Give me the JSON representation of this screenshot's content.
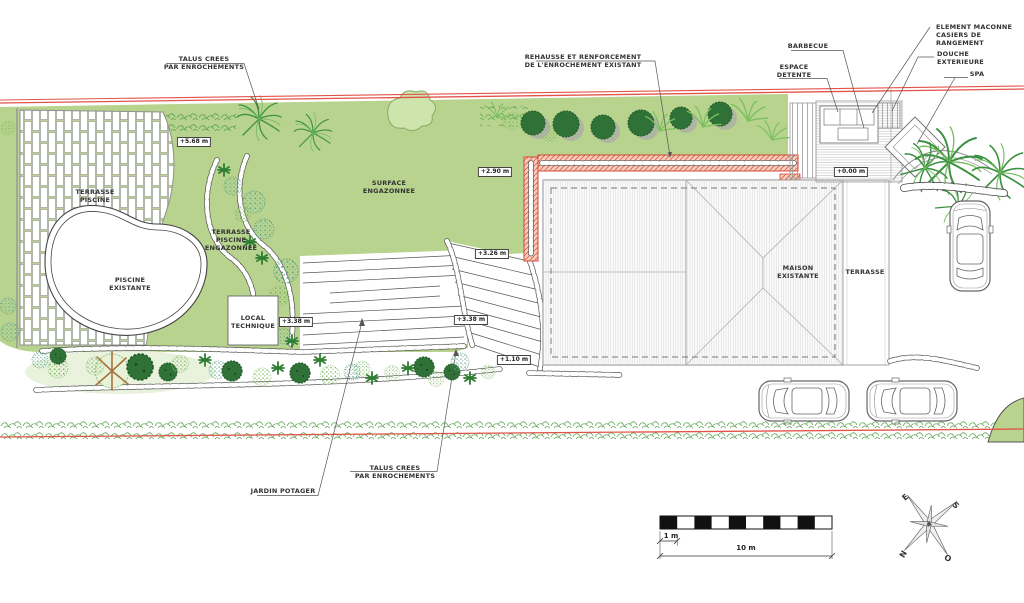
{
  "annotations": {
    "talus_top": {
      "line1": "TALUS CREES",
      "line2": "PAR ENROCHEMENTS"
    },
    "rehausse": {
      "line1": "REHAUSSE ET RENFORCEMENT",
      "line2": "DE L'ENROCHEMENT EXISTANT"
    },
    "barbecue": {
      "label": "BARBECUE"
    },
    "espace_detente": {
      "line1": "ESPACE",
      "line2": "DETENTE"
    },
    "element_maconne": {
      "line1": "ELEMENT MACONNE",
      "line2": "CASIERS DE",
      "line3": "RANGEMENT"
    },
    "douche": {
      "line1": "DOUCHE",
      "line2": "EXTERIEURE"
    },
    "spa": {
      "label": "SPA"
    },
    "terrasse_piscine": {
      "line1": "TERRASSE",
      "line2": "PISCINE"
    },
    "surface_engazonnee": {
      "line1": "SURFACE",
      "line2": "ENGAZONNEE"
    },
    "terrasse_piscine_engazonnee": {
      "line1": "TERRASSE",
      "line2": "PISCINE",
      "line3": "ENGAZONNEE"
    },
    "piscine_existante": {
      "line1": "PISCINE",
      "line2": "EXISTANTE"
    },
    "local_technique": {
      "line1": "LOCAL",
      "line2": "TECHNIQUE"
    },
    "maison_existante": {
      "line1": "MAISON",
      "line2": "EXISTANTE"
    },
    "terrasse_maison": {
      "label": "TERRASSE"
    },
    "jardin_potager": {
      "label": "JARDIN POTAGER"
    },
    "talus_bottom": {
      "line1": "TALUS CREES",
      "line2": "PAR ENROCHEMENTS"
    }
  },
  "elevations": {
    "terrace_top": "+5.68 m",
    "lawn_upper": "+2.90 m",
    "lawn_mid": "+3.26 m",
    "steps_left": "+3.38 m",
    "steps_right": "+3.38 m",
    "lower_garden": "+1.10 m",
    "house_level": "+0.00 m"
  },
  "scale": {
    "small": "1 m",
    "large": "10 m"
  },
  "compass": {
    "n": "N",
    "s": "S",
    "e": "E",
    "o": "O"
  },
  "colors": {
    "lawn": "#b8d38e",
    "boundary_red": "#e2544a",
    "enrochement_hatch": "#d8604e",
    "enrochement_bg": "#f8cdbb",
    "tree_dark": "#2f7136",
    "tree_light": "#cde4ad",
    "line_gray": "#555555"
  }
}
